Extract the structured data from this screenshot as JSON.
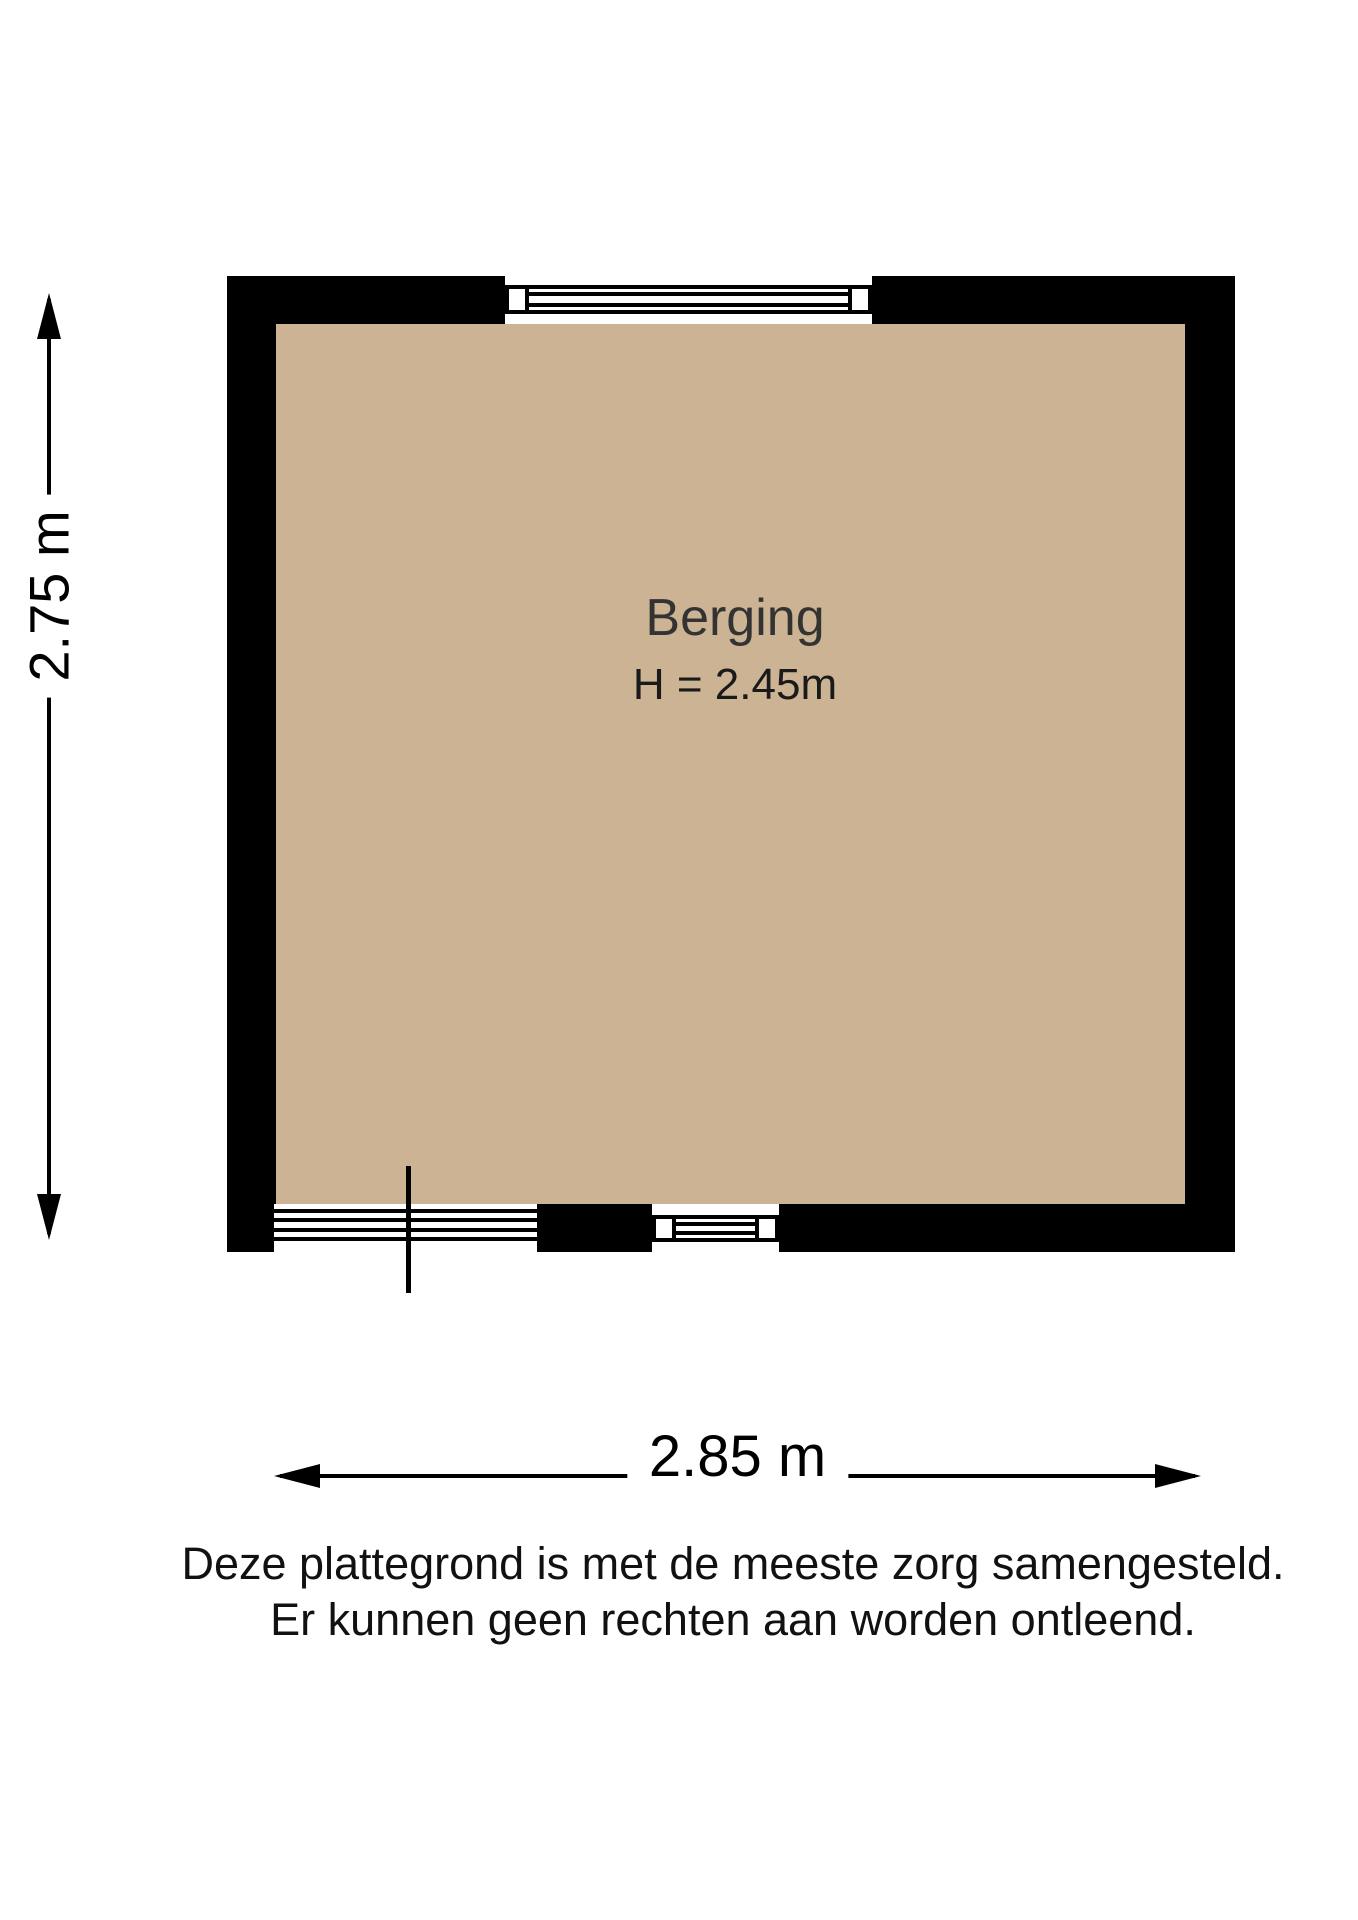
{
  "floorplan": {
    "room": {
      "label": "Berging",
      "height_label": "H = 2.45m"
    },
    "dimensions": {
      "vertical": "2.75 m",
      "horizontal": "2.85 m"
    },
    "disclaimer": {
      "line1": "Deze plattegrond is met de meeste zorg samengesteld.",
      "line2": "Er kunnen geen rechten aan worden ontleend."
    },
    "colors": {
      "wall": "#000000",
      "floor": "#CBB393",
      "background": "#FFFFFF",
      "room_label_text": "#333333",
      "dimension_text": "#000000",
      "disclaimer_text": "#111111"
    }
  }
}
